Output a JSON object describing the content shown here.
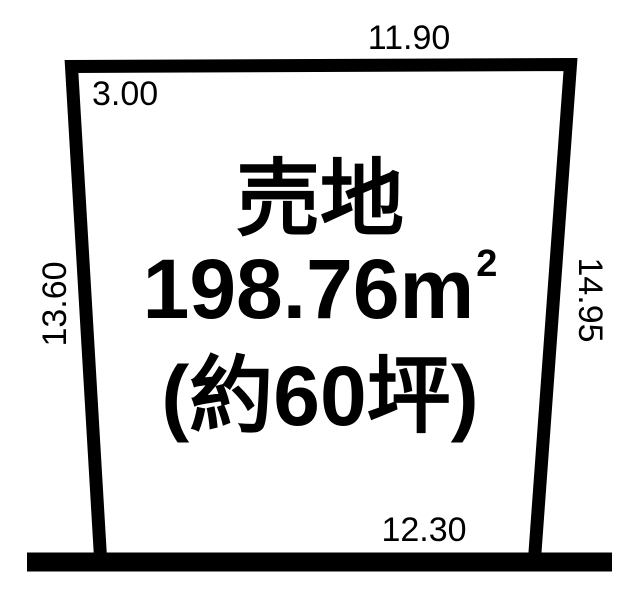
{
  "plot": {
    "label": "売地",
    "area_value": "198.76",
    "area_unit": "m",
    "area_exponent": "2",
    "area_tsubo": "(約60坪)",
    "dimensions": {
      "top": "11.90",
      "corner_top_left": "3.00",
      "left": "13.60",
      "right": "14.95",
      "bottom": "12.30"
    }
  },
  "colors": {
    "line": "#000000",
    "background": "#ffffff",
    "text": "#000000"
  }
}
